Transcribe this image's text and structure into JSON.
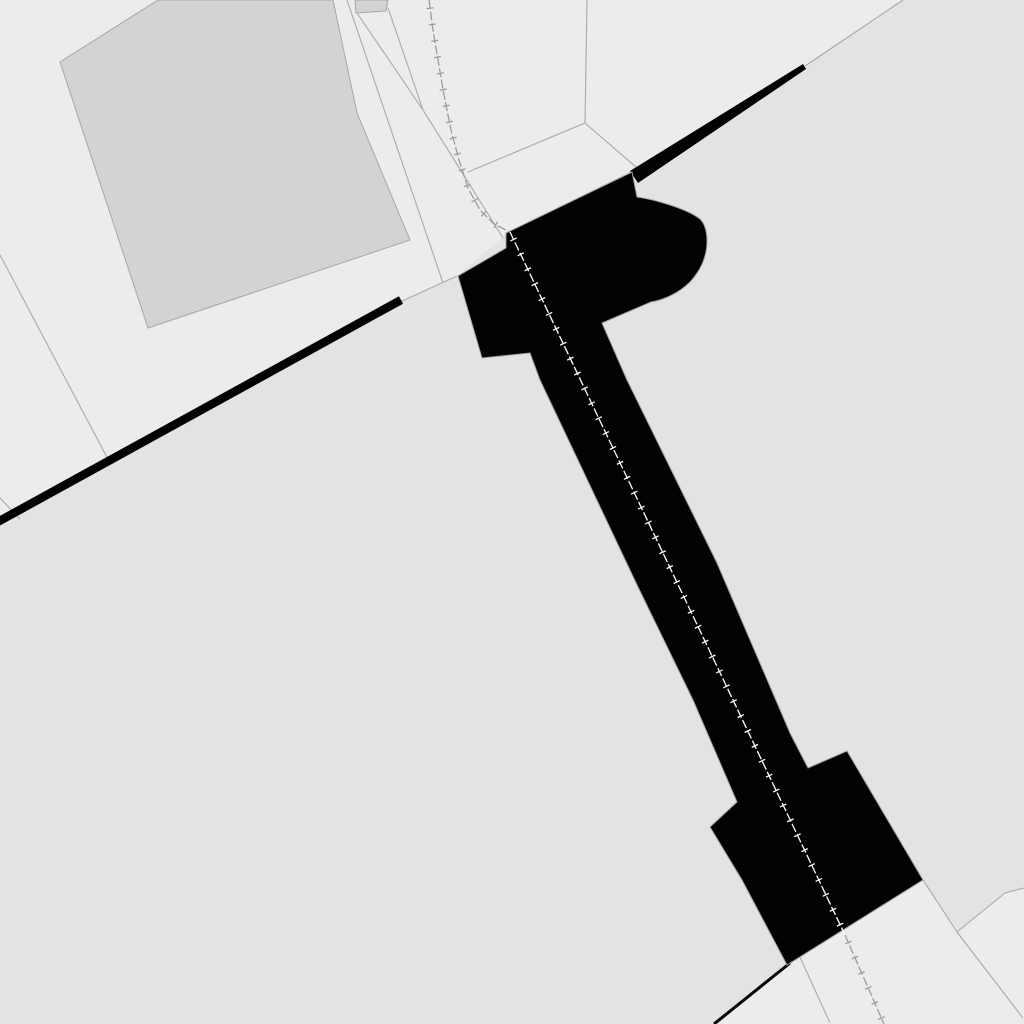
{
  "map": {
    "title": "cadastral-map-view",
    "canvas": {
      "width": 1024,
      "height": 1024
    },
    "colors": {
      "background_light": "#ececec",
      "parcel_region_dark": "#e3e3e3",
      "building_fill": "#d3d3d3",
      "building_stroke": "#a6a6a6",
      "boundary_line": "#a9a9a9",
      "structure_fill": "#020202",
      "structure_stroke": "#a0a0a0",
      "railway_gray": "#9c9c9c",
      "railway_white": "#ffffff"
    },
    "regions": [
      {
        "name": "parcel-region-dark-band",
        "fill": "parcel_region_dark",
        "points": [
          [
            903,
            0
          ],
          [
            805,
            66
          ],
          [
            637,
            168
          ],
          [
            510,
            231
          ],
          [
            457,
            276
          ],
          [
            400,
            302
          ],
          [
            0,
            522
          ],
          [
            0,
            1024
          ],
          [
            718,
            1024
          ],
          [
            790,
            964
          ],
          [
            923,
            880
          ],
          [
            957,
            932
          ],
          [
            1005,
            893
          ],
          [
            1024,
            888
          ],
          [
            1024,
            0
          ]
        ]
      }
    ],
    "buildings": [
      {
        "name": "building-large-parallelogram",
        "fill": "building_fill",
        "stroke": "building_stroke",
        "points": [
          [
            60,
            62
          ],
          [
            158,
            0
          ],
          [
            333,
            0
          ],
          [
            357,
            113
          ],
          [
            410,
            240
          ],
          [
            148,
            328
          ]
        ]
      },
      {
        "name": "building-small-clipped",
        "fill": "building_fill",
        "stroke": "building_stroke",
        "points": [
          [
            355,
            0
          ],
          [
            388,
            0
          ],
          [
            386,
            11
          ],
          [
            356,
            13
          ]
        ]
      }
    ],
    "parcel_lines": [
      {
        "name": "parcel-line-west",
        "pts": [
          [
            0,
            255
          ],
          [
            110,
            463
          ]
        ]
      },
      {
        "name": "parcel-line-west-stub",
        "pts": [
          [
            0,
            498
          ],
          [
            20,
            519
          ]
        ]
      },
      {
        "name": "parcel-line-corridor-a",
        "pts": [
          [
            347,
            0
          ],
          [
            443,
            283
          ]
        ]
      },
      {
        "name": "parcel-line-corridor-b1",
        "pts": [
          [
            357,
            13
          ],
          [
            423,
            110
          ]
        ]
      },
      {
        "name": "parcel-line-corridor-b2",
        "pts": [
          [
            388,
            8
          ],
          [
            423,
            110
          ]
        ]
      },
      {
        "name": "parcel-line-corridor-b3",
        "pts": [
          [
            423,
            110
          ],
          [
            503,
            238
          ]
        ]
      },
      {
        "name": "parcel-line-branch",
        "pts": [
          [
            468,
            172
          ],
          [
            585,
            123
          ]
        ]
      },
      {
        "name": "parcel-line-vertical",
        "pts": [
          [
            587,
            0
          ],
          [
            585,
            123
          ]
        ]
      },
      {
        "name": "parcel-line-to-wedge",
        "pts": [
          [
            585,
            123
          ],
          [
            637,
            168
          ]
        ]
      },
      {
        "name": "parcel-line-diagonal-ne",
        "pts": [
          [
            805,
            66
          ],
          [
            903,
            0
          ]
        ]
      },
      {
        "name": "parcel-line-diagonal-gap",
        "pts": [
          [
            400,
            302
          ],
          [
            457,
            276
          ]
        ]
      },
      {
        "name": "parcel-line-south-a",
        "pts": [
          [
            800,
            957
          ],
          [
            830,
            1023
          ]
        ]
      },
      {
        "name": "parcel-line-south-b",
        "pts": [
          [
            957,
            932
          ],
          [
            1023,
            1018
          ]
        ]
      },
      {
        "name": "parcel-line-corner-a",
        "pts": [
          [
            923,
            880
          ],
          [
            957,
            932
          ]
        ]
      },
      {
        "name": "parcel-line-corner-b",
        "pts": [
          [
            957,
            932
          ],
          [
            1005,
            893
          ],
          [
            1024,
            888
          ]
        ]
      }
    ],
    "thick_boundary_lines": [
      {
        "name": "boundary-thick-southwest",
        "pts": [
          [
            -6,
            524
          ],
          [
            401,
            300
          ]
        ],
        "width": 8.5
      },
      {
        "name": "boundary-thin-south",
        "pts": [
          [
            790,
            963
          ],
          [
            714,
            1024
          ]
        ],
        "width": 3
      }
    ],
    "boundary_wedge": {
      "name": "boundary-wedge-northeast",
      "points": [
        [
          630,
          171
        ],
        [
          803,
          64
        ],
        [
          806,
          69
        ],
        [
          638,
          183
        ]
      ]
    },
    "structure": {
      "name": "bridge-structure",
      "path": "M508,232 L632,172 L637,197 C652,199 686,208 700,219 C705,224 707,231 707,241 C707,256 701,270 690,282 C679,293 664,300 651,302 L602,323 L627,380 L717,563 L790,733 L808,768 L847,751 L923,880 L787,965 L742,880 L710,827 L737,802 L693,700 L638,587 L540,380 L530,353 L482,358 L458,276 L506,248 L506,233 Z"
    },
    "railway": {
      "tick_spacing": 16.5,
      "tick_length": 7,
      "line_width": 1.3,
      "segments": [
        {
          "name": "railway-segment-north",
          "color": "railway_gray",
          "pts": [
            [
              429,
              0
            ],
            [
              433,
              30
            ],
            [
              438,
              60
            ],
            [
              444,
              95
            ],
            [
              451,
              130
            ],
            [
              459,
              160
            ],
            [
              468,
              188
            ],
            [
              480,
              210
            ],
            [
              494,
              224
            ],
            [
              510,
              232
            ]
          ]
        },
        {
          "name": "railway-segment-on-bridge",
          "color": "railway_white",
          "pts": [
            [
              510,
              232
            ],
            [
              845,
              935
            ]
          ]
        },
        {
          "name": "railway-segment-south",
          "color": "railway_gray",
          "pts": [
            [
              845,
              935
            ],
            [
              884,
              1024
            ]
          ]
        }
      ]
    }
  }
}
